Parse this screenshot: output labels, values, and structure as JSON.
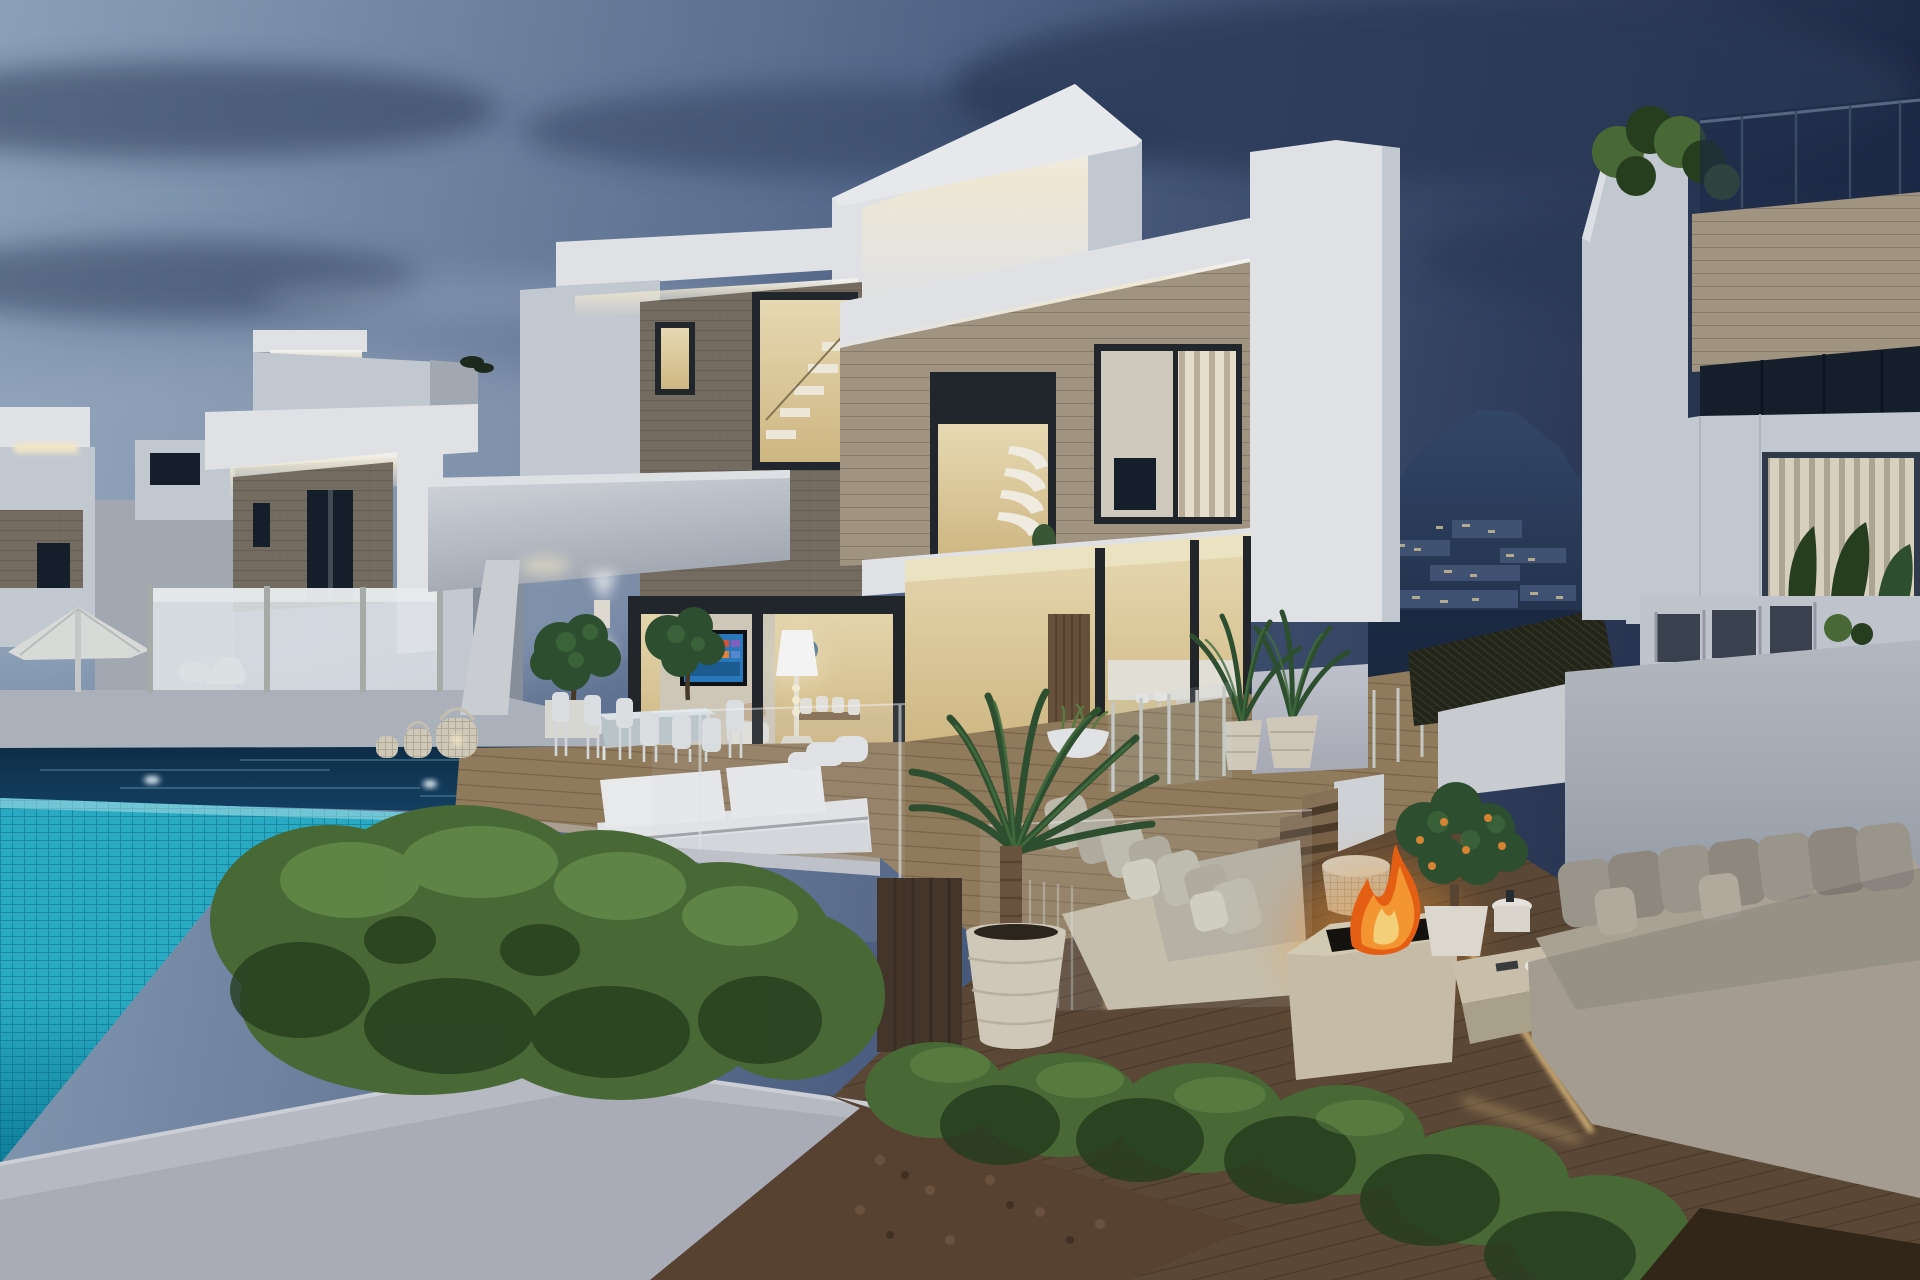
{
  "meta": {
    "title": "Modern luxury villa with infinity pool at dusk",
    "media_type": "3d-architectural-rendering",
    "time_of_day": "dusk",
    "width_px": 1920,
    "height_px": 1280
  },
  "palette": {
    "sky_left": "#92a8c0",
    "sky_mid": "#54688c",
    "sky_right": "#1e2a46",
    "cloud_dark": "#2b3b58",
    "cloud_soft": "#a7b7cb",
    "mountain_top": "#35496b",
    "mountain_bottom": "#1a2940",
    "town_light": "#cfc49b",
    "wall_lit": "#eaedf0",
    "wall_mid": "#ccd2d9",
    "wall_shade": "#a9b0ba",
    "wall_dark": "#8d95a0",
    "glow_warm": "#fff3cf",
    "led_warm": "#ffd98f",
    "stone_dark": "#7a7164",
    "stone_line": "#5f574c",
    "wood_clad": "#a89a85",
    "frame_dark": "#22272e",
    "window_dark": "#161f2c",
    "interior_warm": "#f2e4ba",
    "interior_deep": "#d9bf87",
    "louver_lit": "#f2e9d3",
    "louver_shade": "#c2b7a0",
    "pool_tile": "#2cb3cb",
    "pool_tile_deep": "#0e84a1",
    "tile_line": "#07647e",
    "pool_dark": "#0d2f49",
    "deck_wood": "#97805f",
    "deck_line": "#54402a",
    "deck_dark": "#5e4a36",
    "travertine": "#cfc5ae",
    "sofa_cream": "#c7c1b1",
    "sofa_gray": "#a29c90",
    "hedge_light": "#7aa556",
    "hedge_mid": "#4b6e37",
    "hedge_dark": "#27401e",
    "palm_green": "#2f5230",
    "palm_light": "#457240",
    "fire_core": "#ffda7e",
    "fire_mid": "#ff9c31",
    "fire_deep": "#f06414",
    "pot_cream": "#dad2c1",
    "white_furniture": "#eef0f2",
    "glass_fence": "#e7edef",
    "umbrella": "#e3e5e2",
    "mulch": "#5b4532",
    "cane_dark": "#24261a",
    "tv_blue": "#2a7ec3",
    "gray_wall": "#b2b8c0"
  },
  "scene": {
    "description": "Two-storey white modern villa at dusk with LED cove lighting, wood-clad accent walls, warm lit interior, covered outdoor dining terrace, turquoise infinity pool, sunken fire-pit lounge with outdoor sofas, potted palms, hedges, neighbouring villas and a mountain with hillside town lights.",
    "elements": [
      {
        "name": "sky",
        "label": "Dusk sky with clouds"
      },
      {
        "name": "mountain-backdrop",
        "label": "Mountain with hillside town lights"
      },
      {
        "name": "villa-far-left",
        "label": "Background villa far left"
      },
      {
        "name": "villa-left",
        "label": "Neighbouring villa left"
      },
      {
        "name": "patio-umbrella",
        "label": "White parasol"
      },
      {
        "name": "glass-pool-fence",
        "label": "Frosted glass pool fence"
      },
      {
        "name": "villa-main",
        "label": "Main villa"
      },
      {
        "name": "rooftop-box",
        "label": "Rooftop volume with LED cove"
      },
      {
        "name": "stair-window",
        "label": "Double-height stair window"
      },
      {
        "name": "louver-window",
        "label": "Window with lit vertical louvers"
      },
      {
        "name": "terrace-canopy",
        "label": "White terrace canopy"
      },
      {
        "name": "outdoor-dining-set",
        "label": "Outdoor dining table and chairs"
      },
      {
        "name": "tv-screen",
        "label": "Wall TV with smart-tv screen"
      },
      {
        "name": "interior-floor-lamp",
        "label": "Glowing floor lamp"
      },
      {
        "name": "wicker-lanterns",
        "label": "Wicker lanterns"
      },
      {
        "name": "daybed",
        "label": "White pool daybed"
      },
      {
        "name": "pool",
        "label": "Turquoise infinity pool"
      },
      {
        "name": "upper-terrace-deck",
        "label": "Wood deck terrace"
      },
      {
        "name": "glass-balustrade",
        "label": "Glass balustrade"
      },
      {
        "name": "terrace-steps",
        "label": "Wood steps to lounge"
      },
      {
        "name": "outdoor-sofa-center",
        "label": "Cream outdoor sofa"
      },
      {
        "name": "outdoor-sofa-right",
        "label": "Grey outdoor sofa"
      },
      {
        "name": "potted-palm",
        "label": "Potted palm tree"
      },
      {
        "name": "fire-pit",
        "label": "Travertine fire pit with flames"
      },
      {
        "name": "orange-tree",
        "label": "Potted orange tree"
      },
      {
        "name": "hedge-large",
        "label": "Large clipped hedge"
      },
      {
        "name": "hedge-row",
        "label": "Low hedge row"
      },
      {
        "name": "boundary-wall",
        "label": "White boundary wall"
      },
      {
        "name": "villa-right",
        "label": "Neighbouring villa right"
      }
    ]
  }
}
